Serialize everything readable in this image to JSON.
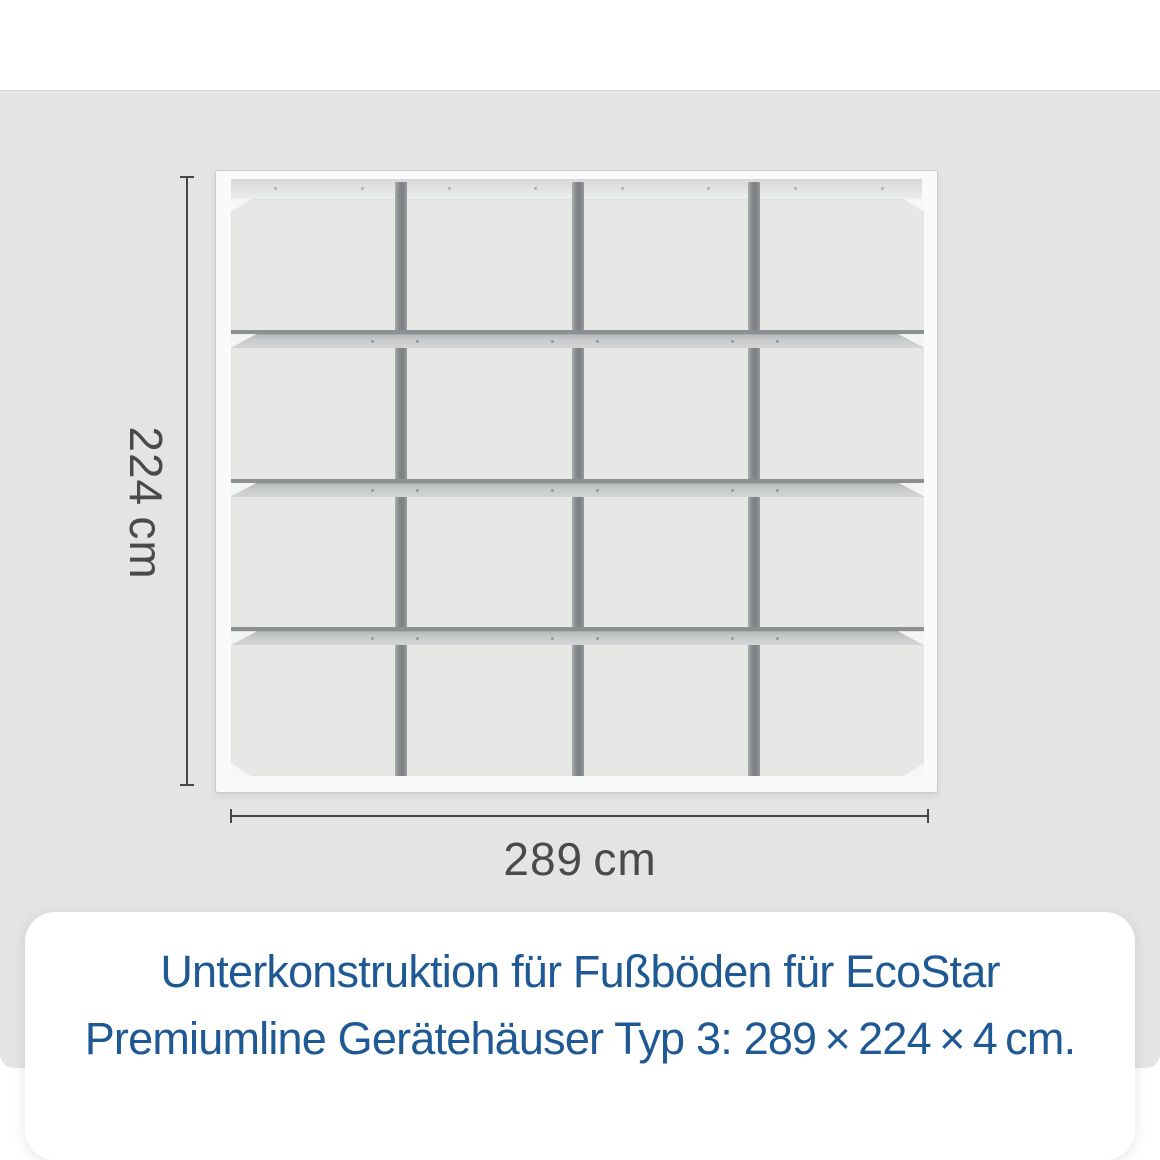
{
  "stage": {
    "background": "#e4e4e3"
  },
  "diagram": {
    "structure": {
      "columns": 4,
      "rows": 4,
      "vertical_beams": 3,
      "horizontal_beams": 3
    },
    "colors": {
      "frame_white": "#fafafa",
      "beam_dark": "#85888b",
      "beam_face_light": "#d2d4d5",
      "dimension_line": "#464646",
      "dimension_text": "#4a4a49"
    },
    "dimensions": {
      "height_label": "224 cm",
      "width_label": "289 cm"
    }
  },
  "caption": {
    "card_background": "#ffffff",
    "text_color": "#1e5994",
    "line1": "Unterkonstruktion für Fußböden für EcoStar",
    "line2": "Premiumline Gerätehäuser Typ 3: 289 × 224 × 4 cm."
  }
}
